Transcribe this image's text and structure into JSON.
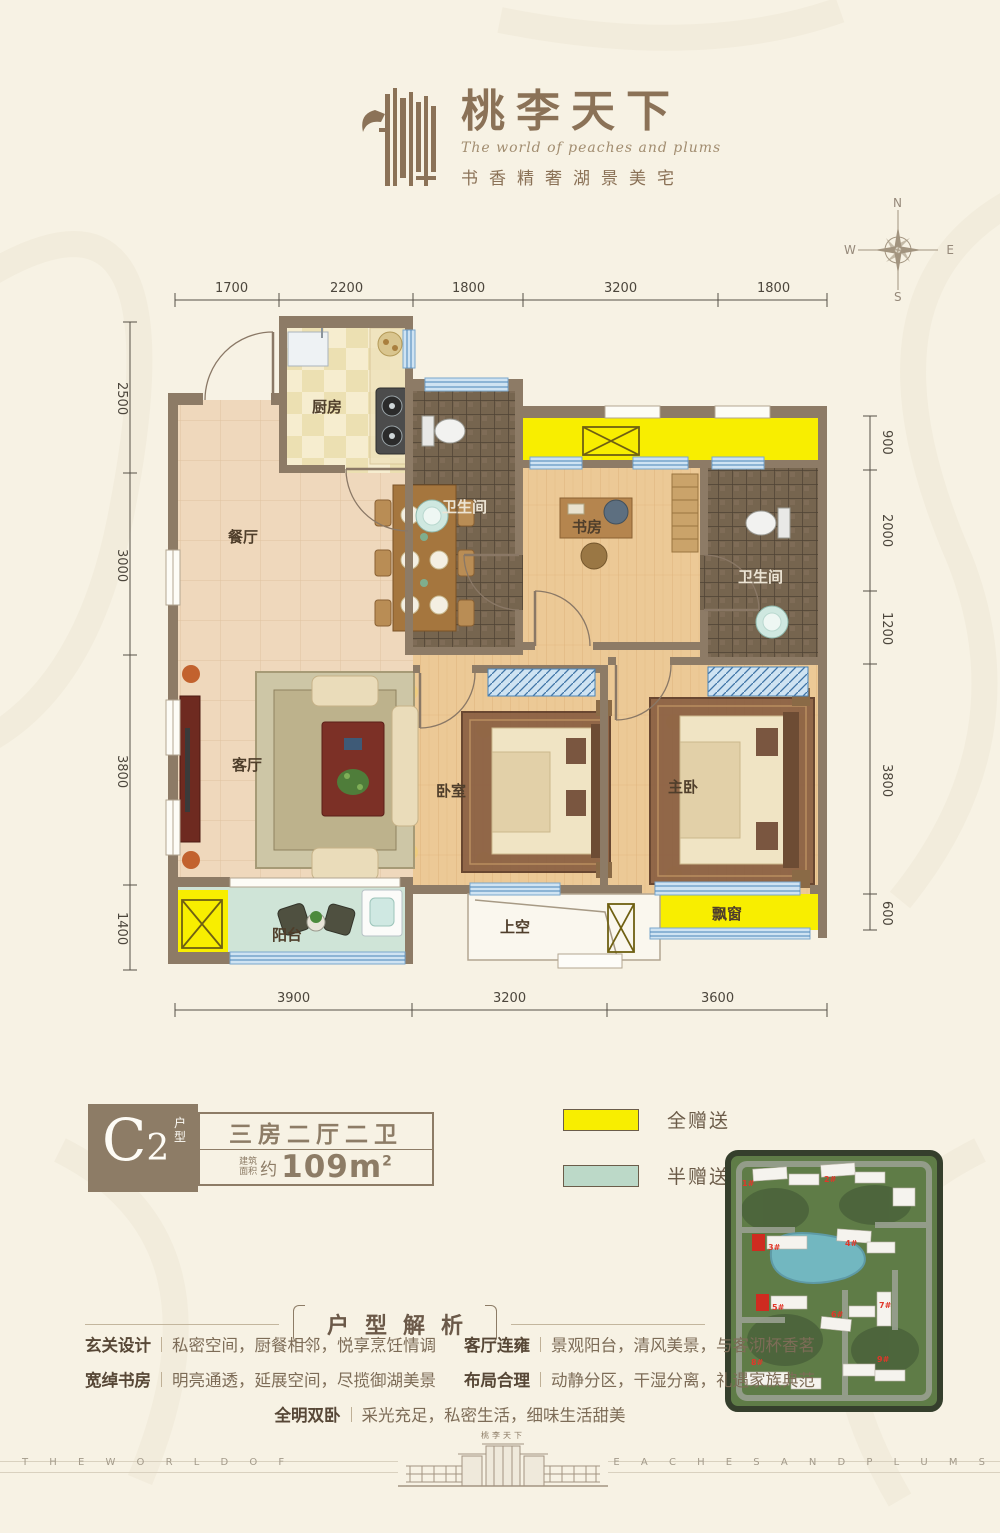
{
  "header": {
    "logo_title": "桃李天下",
    "logo_en": "The world of peaches and plums",
    "logo_tagline": "书香精奢湖景美宅"
  },
  "compass": {
    "n": "N",
    "e": "E",
    "s": "S",
    "w": "W"
  },
  "floor_plan": {
    "rooms": {
      "kitchen": "厨房",
      "dining": "餐厅",
      "bath1": "卫生间",
      "study": "书房",
      "bath2": "卫生间",
      "living": "客厅",
      "bedroom": "卧室",
      "master": "主卧",
      "balcony": "阳台",
      "void": "上空",
      "bay_window": "飘窗"
    },
    "dims_top": [
      "1700",
      "2200",
      "1800",
      "3200",
      "1800"
    ],
    "dims_left": [
      "2500",
      "3000",
      "3800",
      "1400"
    ],
    "dims_right": [
      "900",
      "2000",
      "1200",
      "3800",
      "600"
    ],
    "dims_bottom": [
      "3900",
      "3200",
      "3600"
    ]
  },
  "unit_info": {
    "code": "C",
    "code_sub": "2",
    "code_tag": "户型",
    "layout": "三房二厅二卫",
    "area_label_1": "建筑",
    "area_label_2": "面积",
    "area_about": "约",
    "area_value": "109m",
    "area_sup": "2"
  },
  "legend": {
    "full_gift": {
      "label": "全赠送",
      "color": "#f8ee00"
    },
    "half_gift": {
      "label": "半赠送",
      "color": "#bcd9c8"
    }
  },
  "site_plan": {
    "buildings": [
      "1#",
      "2#",
      "3#",
      "4#",
      "5#",
      "6#",
      "7#",
      "8#",
      "9#"
    ],
    "highlighted": [
      "3#",
      "5#"
    ]
  },
  "analysis": {
    "title": "户型解析",
    "items": [
      {
        "label": "玄关设计",
        "text": "私密空间，厨餐相邻，悦享烹饪情调"
      },
      {
        "label": "宽绰书房",
        "text": "明亮通透，延展空间，尽揽御湖美景"
      },
      {
        "label": "全明双卧",
        "text": "采光充足，私密生活，细味生活甜美"
      },
      {
        "label": "客厅连雍",
        "text": "景观阳台，清风美景，与客沏杯香茗"
      },
      {
        "label": "布局合理",
        "text": "动静分区，干湿分离，礼遇家族典范"
      }
    ]
  },
  "footer": {
    "left": "T H E W O R L D O F",
    "right": "P E A C H E S A N D P L U M S",
    "gate_label": "桃李天下"
  }
}
